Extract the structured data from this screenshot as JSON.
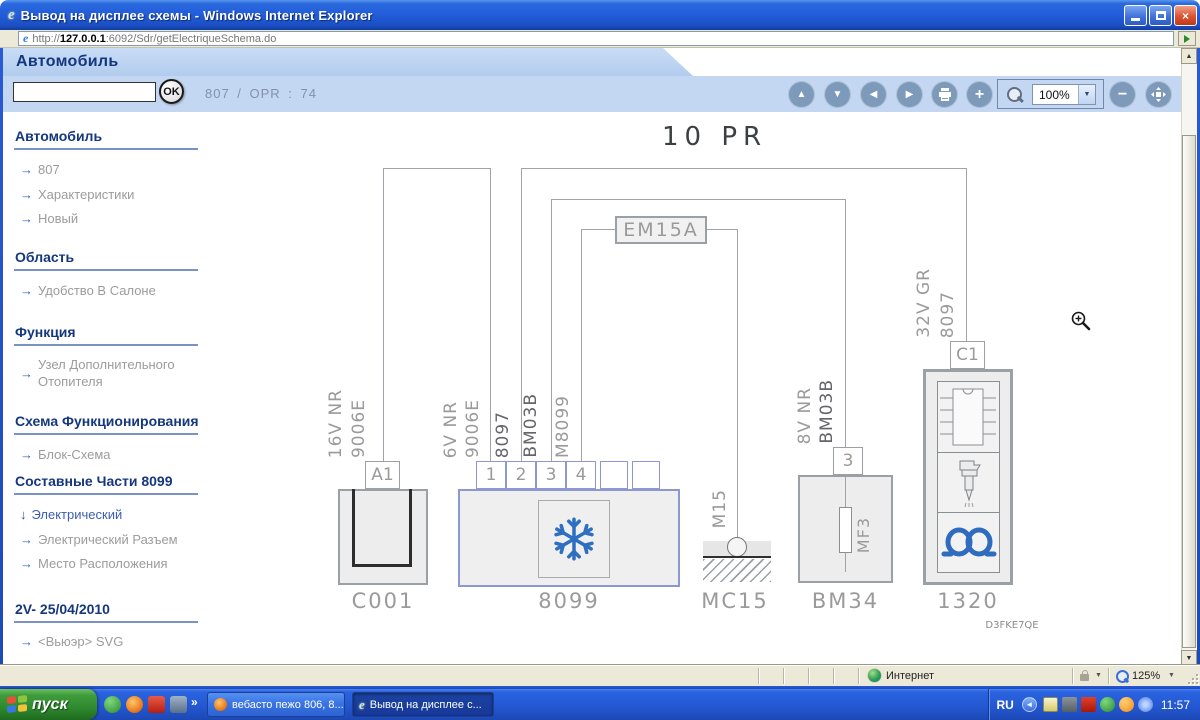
{
  "icons": {
    "close": "×",
    "up": "▲",
    "down": "▼",
    "left": "◀",
    "right": "▶",
    "plus": "+",
    "minus": "−",
    "dropdown": "▼",
    "overflow": "»",
    "tray_collapse": "◄",
    "link_arrow": "→",
    "active_arrow": "↓",
    "ie": "e",
    "scroll_up": "▲",
    "scroll_down": "▼"
  },
  "titlebar": {
    "title": "Вывод на дисплее схемы - Windows Internet Explorer"
  },
  "addressbar": {
    "protocol": "http://",
    "host": "127.0.0.1",
    "path": ":6092/Sdr/getElectriqueSchema.do"
  },
  "header": {
    "app_title": "Автомобиль",
    "ok": "OK",
    "ref": "807 / OPR : 74"
  },
  "toolbar": {
    "zoom_value": "100%"
  },
  "sidebar": {
    "sections": [
      {
        "heading": "Автомобиль",
        "items": [
          {
            "label": "807"
          },
          {
            "label": "Характеристики"
          },
          {
            "label": "Новый"
          }
        ]
      },
      {
        "heading": "Область",
        "items": [
          {
            "label": "Удобство В Салоне"
          }
        ]
      },
      {
        "heading": "Функция",
        "items": [
          {
            "label": "Узел Дополнительного Отопителя"
          }
        ]
      },
      {
        "heading": "Схема Функционирования",
        "items": [
          {
            "label": "Блок-Схема"
          }
        ]
      },
      {
        "heading": "Составные Части 8099",
        "items": [
          {
            "label": "Электрический"
          },
          {
            "label": "Электрический Разъем"
          },
          {
            "label": "Место Расположения"
          }
        ]
      },
      {
        "heading": "2V- 25/04/2010",
        "items": [
          {
            "label": "<Вьюэр> SVG"
          }
        ]
      }
    ]
  },
  "diagram": {
    "title": "10 PR",
    "relay": "EM15A",
    "code": "D3FKE7QE",
    "c001": {
      "terminal": "A1",
      "label": "C001",
      "wire": [
        "16V NR",
        "9006E"
      ]
    },
    "u8099": {
      "label": "8099",
      "terminals": [
        "1",
        "2",
        "3",
        "4"
      ],
      "t1_wire": [
        "6V NR",
        "9006E"
      ],
      "t2_wire": "8097",
      "t3_wire": "BM03B",
      "t4_wire": "M8099"
    },
    "mc15": {
      "label": "MC15",
      "wire": "M15"
    },
    "bm34": {
      "label": "BM34",
      "terminal": "3",
      "wire": [
        "8V NR",
        "BM03B"
      ],
      "fuse": "MF3"
    },
    "u1320": {
      "label": "1320",
      "terminal": "C1",
      "wire": [
        "32V GR",
        "8097"
      ]
    }
  },
  "statusbar": {
    "zone": "Интернет",
    "zoom": "125%"
  },
  "taskbar": {
    "start": "пуск",
    "tasks": [
      "вебасто пежо 806, 8...",
      "Вывод на дисплее с..."
    ],
    "lang": "RU",
    "clock": "11:57"
  }
}
